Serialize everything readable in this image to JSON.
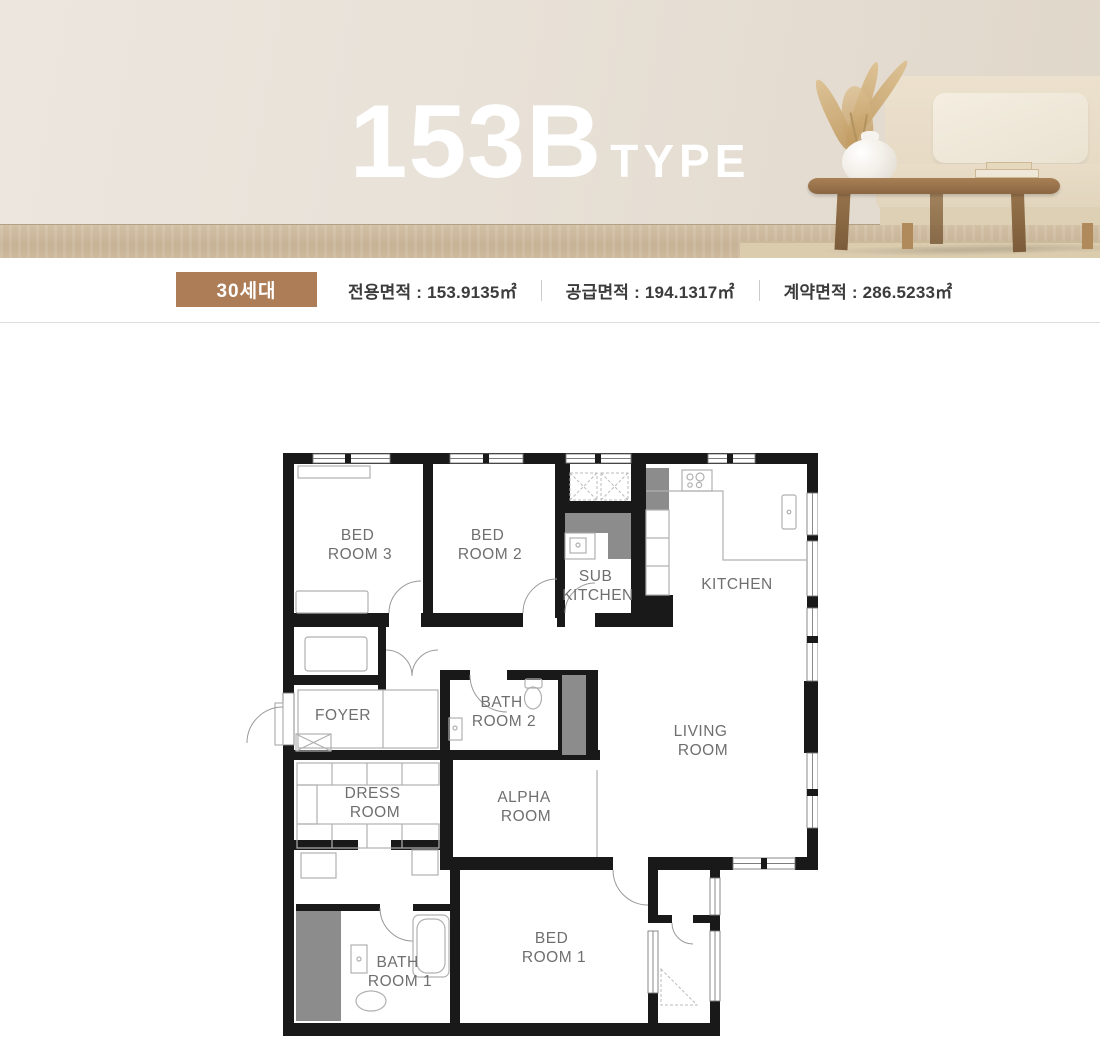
{
  "hero": {
    "title_main": "153B",
    "title_sub": "TYPE"
  },
  "info_bar": {
    "badge": "30세대",
    "items": [
      {
        "label": "전용면적",
        "value": "153.9135㎡",
        "text": "전용면적 : 153.9135㎡"
      },
      {
        "label": "공급면적",
        "value": "194.1317㎡",
        "text": "공급면적 :  194.1317㎡"
      },
      {
        "label": "계약면적",
        "value": "286.5233㎡",
        "text": "계약면적 : 286.5233㎡"
      }
    ]
  },
  "plan": {
    "rooms": [
      {
        "id": "bedroom3",
        "line1": "BED",
        "line2": "ROOM 3"
      },
      {
        "id": "bedroom2",
        "line1": "BED",
        "line2": "ROOM 2"
      },
      {
        "id": "sub-kitchen",
        "line1": "SUB",
        "line2": "KITCHEN"
      },
      {
        "id": "kitchen",
        "line1": "KITCHEN",
        "line2": ""
      },
      {
        "id": "foyer",
        "line1": "FOYER",
        "line2": ""
      },
      {
        "id": "bathroom2",
        "line1": "BATH",
        "line2": "ROOM 2"
      },
      {
        "id": "living-room",
        "line1": "LIVING",
        "line2": "ROOM"
      },
      {
        "id": "dress-room",
        "line1": "DRESS",
        "line2": "ROOM"
      },
      {
        "id": "alpha-room",
        "line1": "ALPHA",
        "line2": "ROOM"
      },
      {
        "id": "bedroom1",
        "line1": "BED",
        "line2": "ROOM 1"
      },
      {
        "id": "bathroom1",
        "line1": "BATH",
        "line2": "ROOM 1"
      }
    ]
  },
  "colors": {
    "accent_brown": "#ad7d57",
    "wall_black": "#191919",
    "duct_gray": "#8c8c8c",
    "label_gray": "#6f6f6f",
    "divider_gray": "#dddddd",
    "hero_wall": "#e8e1d7",
    "hero_floor": "#c7b296",
    "title_white": "#ffffff"
  }
}
